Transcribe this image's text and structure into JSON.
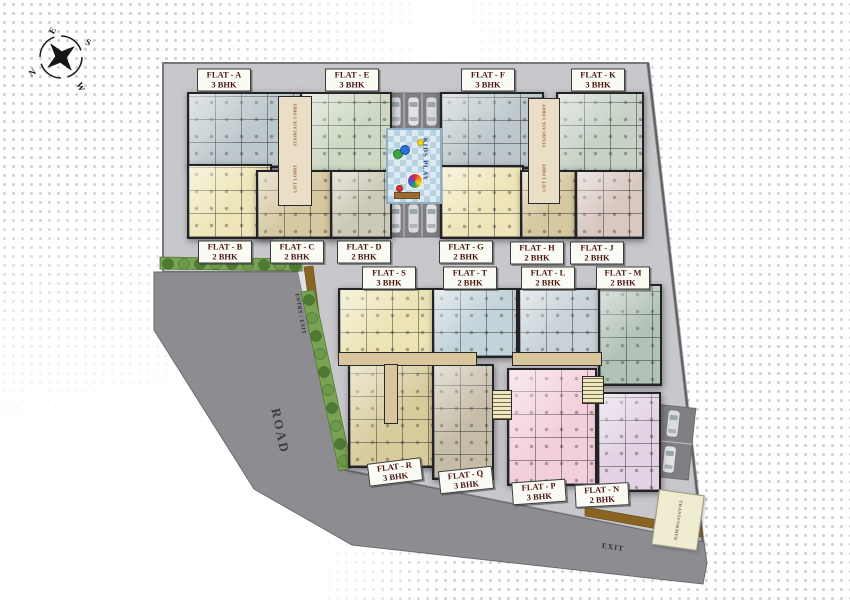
{
  "compass": {
    "north": "N",
    "south": "S",
    "east": "E",
    "west": "W"
  },
  "site": {
    "road_label": "ROAD",
    "entry_label": "ENTRY / EXIT",
    "exit_label": "EXIT",
    "kids_play_label": "KIDS PLAY",
    "transformer_label": "TRANSFORMER",
    "staircase_lobby_label": "STAIRCASE LOBBY",
    "lift_lobby_label": "LIFT LOBBY"
  },
  "flats": [
    {
      "id": "A",
      "label": "FLAT - A",
      "bhk": "3 BHK"
    },
    {
      "id": "E",
      "label": "FLAT - E",
      "bhk": "3 BHK"
    },
    {
      "id": "F",
      "label": "FLAT - F",
      "bhk": "3 BHK"
    },
    {
      "id": "K",
      "label": "FLAT - K",
      "bhk": "3 BHK"
    },
    {
      "id": "B",
      "label": "FLAT - B",
      "bhk": "2 BHK"
    },
    {
      "id": "C",
      "label": "FLAT - C",
      "bhk": "2 BHK"
    },
    {
      "id": "D",
      "label": "FLAT - D",
      "bhk": "2 BHK"
    },
    {
      "id": "G",
      "label": "FLAT - G",
      "bhk": "2 BHK"
    },
    {
      "id": "H",
      "label": "FLAT - H",
      "bhk": "2 BHK"
    },
    {
      "id": "J",
      "label": "FLAT - J",
      "bhk": "2 BHK"
    },
    {
      "id": "S",
      "label": "FLAT - S",
      "bhk": "3 BHK"
    },
    {
      "id": "T",
      "label": "FLAT - T",
      "bhk": "2 BHK"
    },
    {
      "id": "L",
      "label": "FLAT - L",
      "bhk": "2 BHK"
    },
    {
      "id": "M",
      "label": "FLAT - M",
      "bhk": "2 BHK"
    },
    {
      "id": "R",
      "label": "FLAT - R",
      "bhk": "3 BHK"
    },
    {
      "id": "Q",
      "label": "FLAT - Q",
      "bhk": "3 BHK"
    },
    {
      "id": "P",
      "label": "FLAT - P",
      "bhk": "3 BHK"
    },
    {
      "id": "N",
      "label": "FLAT - N",
      "bhk": "2 BHK"
    }
  ],
  "flat_colors": {
    "A": "#bcc8cc",
    "E": "#cdd9c4",
    "F": "#bcc8cc",
    "K": "#c6d2c6",
    "B": "#eee6b8",
    "C": "#d6c8a0",
    "D": "#cccab6",
    "G": "#eee6b8",
    "H": "#d6c8a0",
    "J": "#d8c8c0",
    "S": "#ece4b4",
    "T": "#c2d3da",
    "L": "#c8d2d8",
    "M": "#b2c2b8",
    "R": "#d8cc9c",
    "Q": "#c6bda8",
    "P": "#f3cfdc",
    "N": "#e2d2e4"
  },
  "palette": {
    "site": "#c8c8cc",
    "road": "#8d8d91",
    "hedge": "#79a253",
    "tree": "#4e7a34",
    "compound_wall": "#8a6423",
    "label_text": "#4a1410",
    "play_area": "#dceaf2"
  }
}
